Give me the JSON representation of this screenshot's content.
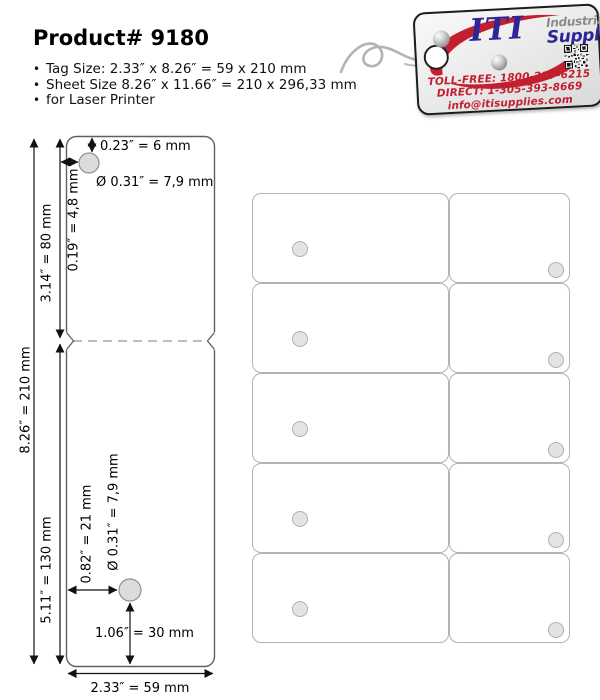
{
  "page": {
    "title": "Product# 9180"
  },
  "bullets": [
    "Tag Size: 2.33″ x 8.26″ = 59 x 210 mm",
    "Sheet Size 8.26″ x 11.66″ = 210 x 296,33 mm",
    "for Laser Printer"
  ],
  "logo": {
    "brand_iti": "ITI",
    "brand_industrial": "Industrial",
    "brand_supplies": "Supplies",
    "toll_free": "TOLL-FREE: 1800-217-6215",
    "direct": "DIRECT: 1-305-393-8669",
    "email": "info@itisupplies.com",
    "colors": {
      "indigo": "#2e2696",
      "red": "#c41f2f",
      "gray": "#8a8a8a"
    }
  },
  "diagram": {
    "labels": {
      "hole_top_offset": "0.23″ = 6 mm",
      "hole_top_diameter": "Ø 0.31″ = 7,9 mm",
      "hole_top_side": "0.19″ = 4,8 mm",
      "top_section_height": "3.14″ = 80 mm",
      "tag_height": "8.26″ = 210 mm",
      "bottom_section_height": "5.11″ = 130 mm",
      "hole_bottom_side": "0.82″ = 21 mm",
      "hole_bottom_diameter": "Ø 0.31″ = 7,9 mm",
      "hole_bottom_offset": "1.06″ = 30 mm",
      "tag_width": "2.33″ = 59 mm"
    }
  },
  "sheet": {
    "rows": 5,
    "columns": 2
  }
}
